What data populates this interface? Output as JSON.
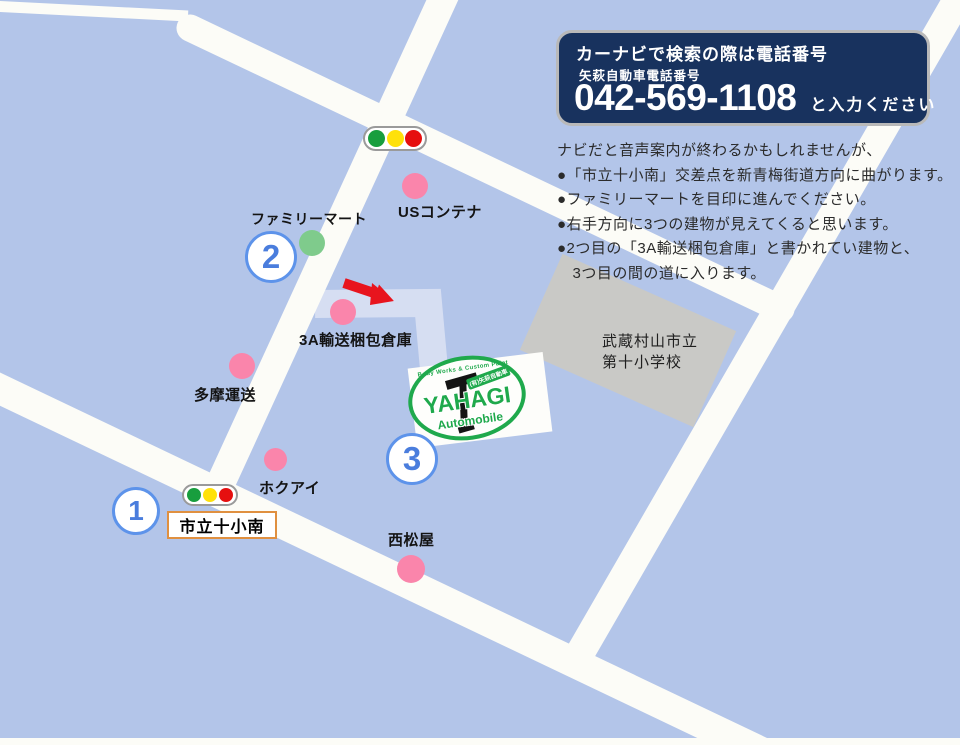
{
  "colors": {
    "bg": "#b3c5e9",
    "road": "#fcfcf7",
    "route": "#d6def2",
    "navy": "#18325e",
    "navy-border": "#b9b9b9",
    "pink": "#fa85ab",
    "green-marker": "#7fcb8c",
    "circle-blue": "#5d93ea",
    "circle-text": "#4a7ddd",
    "orange": "#e09040",
    "arrow-red": "#e8141e",
    "logo-green": "#1fa94c",
    "school-gray": "#c9c9c6",
    "light-green": "#189e3e",
    "light-yellow": "#ffe10a",
    "light-red": "#e60f0f",
    "text-dark": "#2b2b2b"
  },
  "info_box": {
    "title": "カーナビで検索の際は電話番号",
    "subtitle": "矢萩自動車電話番号",
    "phone": "042-569-1108",
    "phone_suffix": "と入力ください"
  },
  "directions": {
    "lines": [
      "ナビだと音声案内が終わるかもしれませんが、",
      "●「市立十小南」交差点を新青梅街道方向に曲がります。",
      "●ファミリーマートを目印に進んでください。",
      "●右手方向に3つの建物が見えてくると思います。",
      "●2つ目の「3A輸送梱包倉庫」と書かれてい建物と、",
      "　3つ目の間の道に入ります。"
    ]
  },
  "map": {
    "landmark_labels": [
      "USコンテナ",
      "ファミリーマート",
      "3A輸送梱包倉庫",
      "多摩運送",
      "ホクアイ",
      "西松屋"
    ],
    "numbered_markers": [
      "1",
      "2",
      "3"
    ],
    "intersection_sign": "市立十小南",
    "school": {
      "line1": "武蔵村山市立",
      "line2": "第十小学校"
    }
  },
  "logo": {
    "arc_text": "Body Works & Custom Paint",
    "badge": "(有)矢萩自動車",
    "name": "YAHAGI",
    "subname": "Automobile"
  }
}
